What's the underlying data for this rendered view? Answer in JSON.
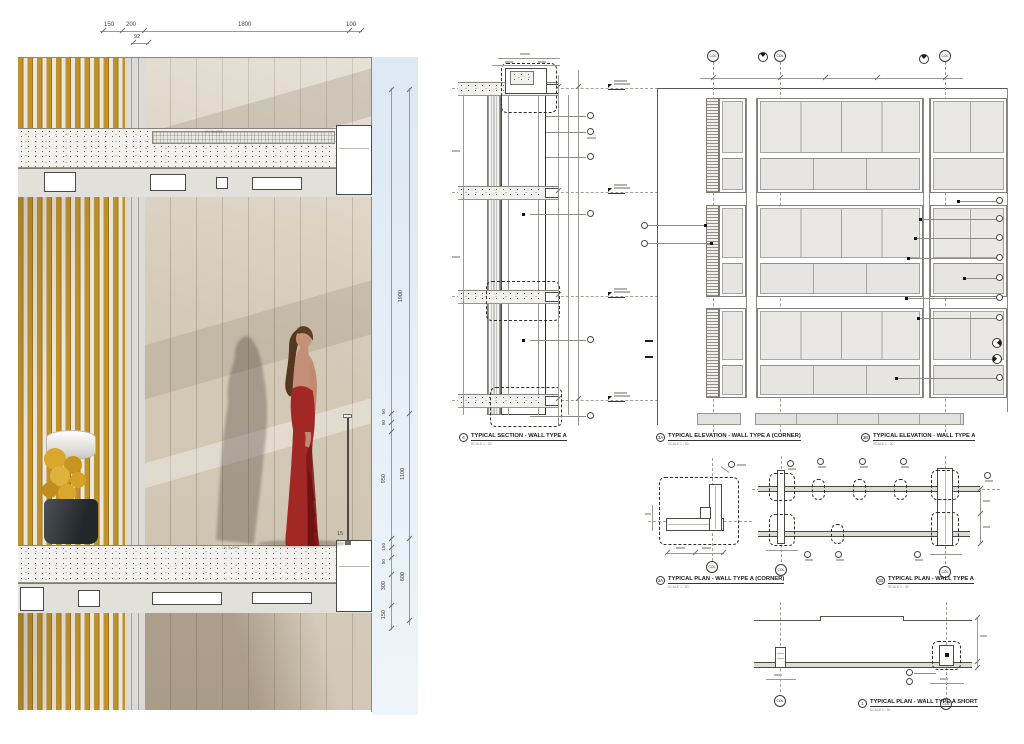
{
  "rendering": {
    "dims_top": [
      "150",
      "200",
      "92",
      "1800",
      "100"
    ],
    "dims_right": [
      "1900",
      "50",
      "50",
      "950",
      "1100",
      "15",
      "150",
      "50",
      "300",
      "600",
      "150"
    ],
    "slope_label_top": "1% SLOPE",
    "slope_label_bottom": "1% SLOPE",
    "colors": {
      "louver_gold": "#c0922c",
      "wall_beige": "#d6ccbb",
      "sky": "#dfeaf4",
      "dress_red": "#a22826",
      "concrete": "#f2f1ed"
    }
  },
  "drawings": {
    "grid_bubble": "COL",
    "section6": {
      "num": "6",
      "title": "TYPICAL SECTION - WALL TYPE A",
      "scale": "SCALE 1 : 30"
    },
    "elev3a": {
      "num": "3A",
      "title": "TYPICAL ELEVATION - WALL TYPE A (CORNER)",
      "scale": "SCALE 1 : 30"
    },
    "elev3b": {
      "num": "3B",
      "title": "TYPICAL ELEVATION - WALL TYPE A",
      "scale": "SCALE 1 : 30"
    },
    "plan2a": {
      "num": "2A",
      "title": "TYPICAL PLAN - WALL TYPE A (CORNER)",
      "scale": "SCALE 1 : 30"
    },
    "plan2b": {
      "num": "2B",
      "title": "TYPICAL PLAN - WALL TYPE A",
      "scale": "SCALE 1 : 30"
    },
    "plan1": {
      "num": "1",
      "title": "TYPICAL PLAN - WALL TYPE A SHORT",
      "scale": "SCALE 1 : 30"
    }
  }
}
